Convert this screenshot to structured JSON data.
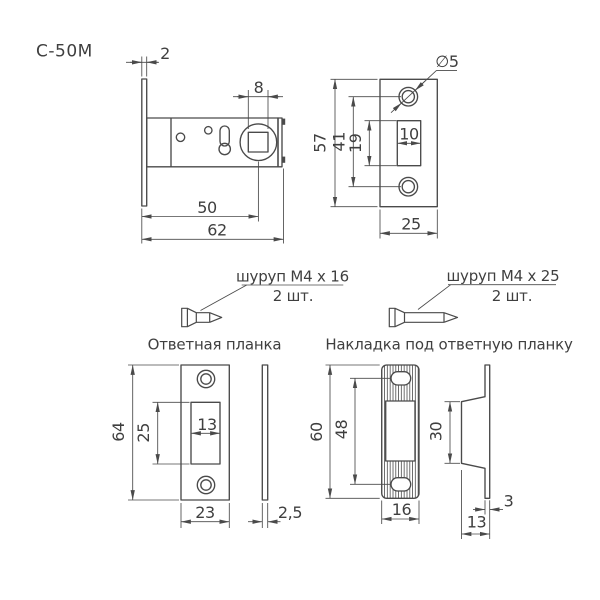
{
  "model": "С-50М",
  "colors": {
    "line": "#4a4a4a",
    "text": "#3f3f3f",
    "background": "#ffffff"
  },
  "latch_view": {
    "dim_faceplate_thickness": "2",
    "dim_square_hole": "8",
    "dim_backset": "50",
    "dim_total_length": "62"
  },
  "faceplate_view": {
    "dim_hole_diameter": "∅5",
    "dim_height": "57",
    "dim_hole_spacing": "41",
    "dim_slot_height": "19",
    "dim_slot_width": "10",
    "dim_width": "25"
  },
  "screw_small": {
    "label": "шуруп М4 х 16",
    "qty": "2 шт."
  },
  "screw_large": {
    "label": "шуруп М4 х 25",
    "qty": "2 шт."
  },
  "strike_plate_view": {
    "title": "Ответная планка",
    "dim_height": "64",
    "dim_slot_height": "25",
    "dim_slot_width": "13",
    "dim_width": "23",
    "dim_thickness": "2,5"
  },
  "overlay_view": {
    "title": "Накладка под ответную планку",
    "dim_height": "60",
    "dim_hole_spacing": "48",
    "dim_width": "16",
    "dim_recess_height": "30",
    "dim_thickness": "3",
    "dim_depth": "13"
  }
}
